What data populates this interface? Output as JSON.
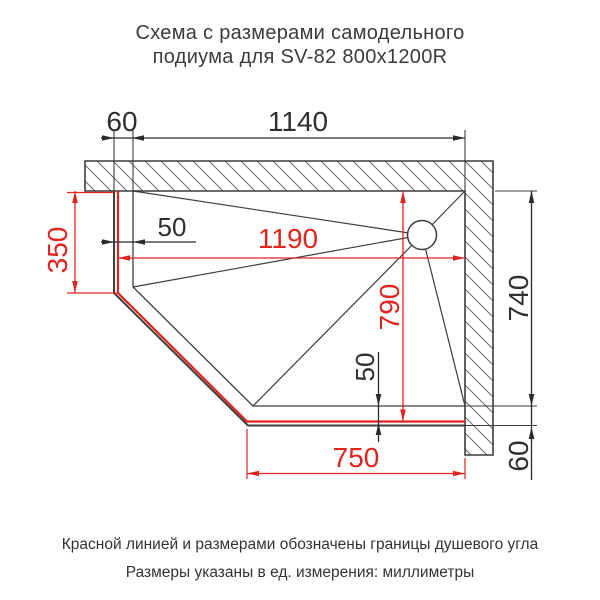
{
  "title": {
    "line1": "Схема с размерами самодельного",
    "line2": "подиума для SV-82 800x1200R"
  },
  "dims": {
    "wall_offset_top": "60",
    "slope_width_top": "1140",
    "slope_height_right": "740",
    "podium_edge_right": "60",
    "rim_inset_left": "50",
    "rim_inset_bottom": "50",
    "shower_side_left": "350",
    "shower_width": "1190",
    "shower_depth": "790",
    "shower_side_bottom": "750"
  },
  "footer": {
    "line1": "Красной линией и размерами обозначены границы душевого угла",
    "line2": "Размеры указаны в ед. измерения: миллиметры"
  },
  "colors": {
    "shower_boundary_red": "#e02420",
    "drawing_line": "#3d3d3d",
    "dimension_text": "#2f2f2f",
    "title_text": "#3b3b3b"
  }
}
